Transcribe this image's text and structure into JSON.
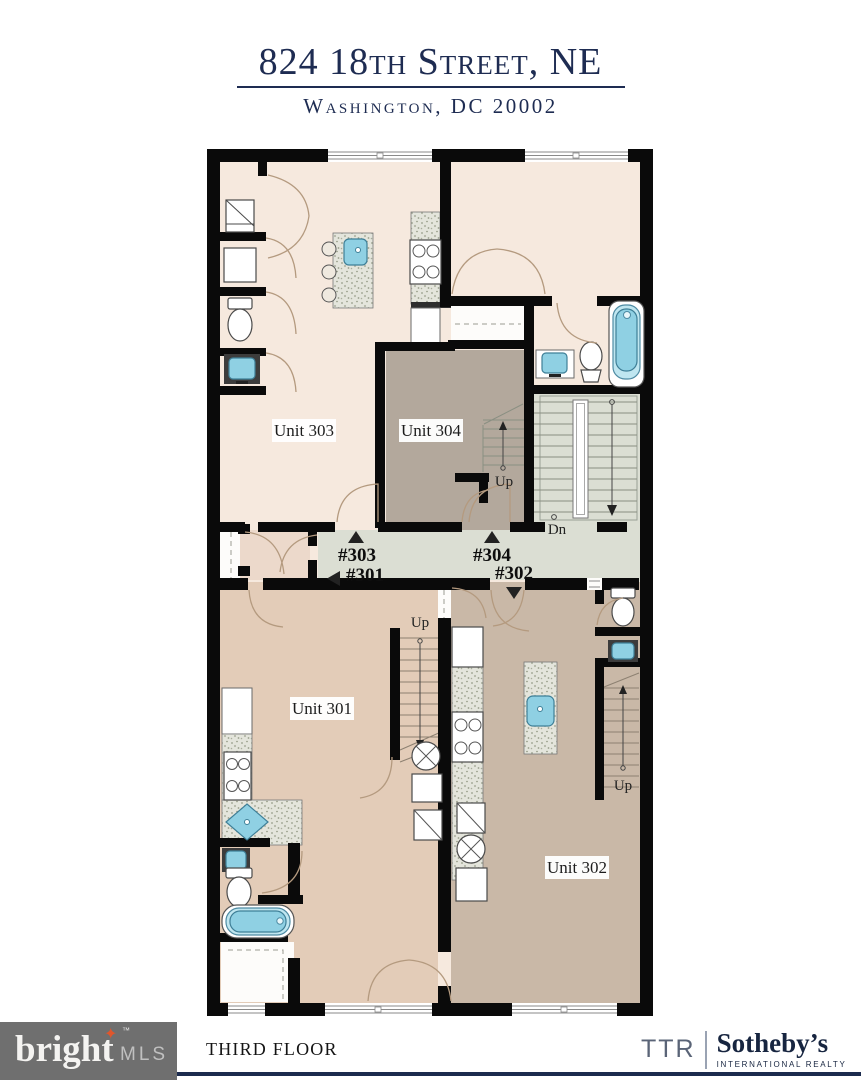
{
  "header": {
    "title": "824 18th Street, NE",
    "subtitle": "Washington, DC 20002"
  },
  "plan": {
    "unit_301": "Unit 301",
    "unit_302": "Unit 302",
    "unit_303": "Unit 303",
    "unit_304": "Unit 304",
    "hall_303": "#303",
    "hall_301": "#301",
    "hall_304": "#304",
    "hall_302": "#302",
    "up": "Up",
    "dn": "Dn"
  },
  "footer": {
    "floor_label": "THIRD FLOOR",
    "bright_mls": {
      "bright": "bright",
      "tm": "™",
      "mls": "MLS",
      "spark": "✦"
    },
    "ttr_sothebys": {
      "ttr": "TTR",
      "sothebys": "Sotheby’s",
      "tagline": "INTERNATIONAL REALTY"
    }
  },
  "colors": {
    "navy": "#1e2c52",
    "wall_black": "#0a0a0a",
    "floor_cream": "#f6e9de",
    "floor_tan_301": "#e3ccb8",
    "floor_tan_302": "#c9b8a7",
    "floor_taupe_304": "#b3a89c",
    "floor_hall": "#dbded3",
    "vestibule": "#ecd9cb",
    "fixture_blue": "#8fd0e3",
    "logo_gray": "#6f6f6f",
    "logo_orange": "#e0562c"
  }
}
